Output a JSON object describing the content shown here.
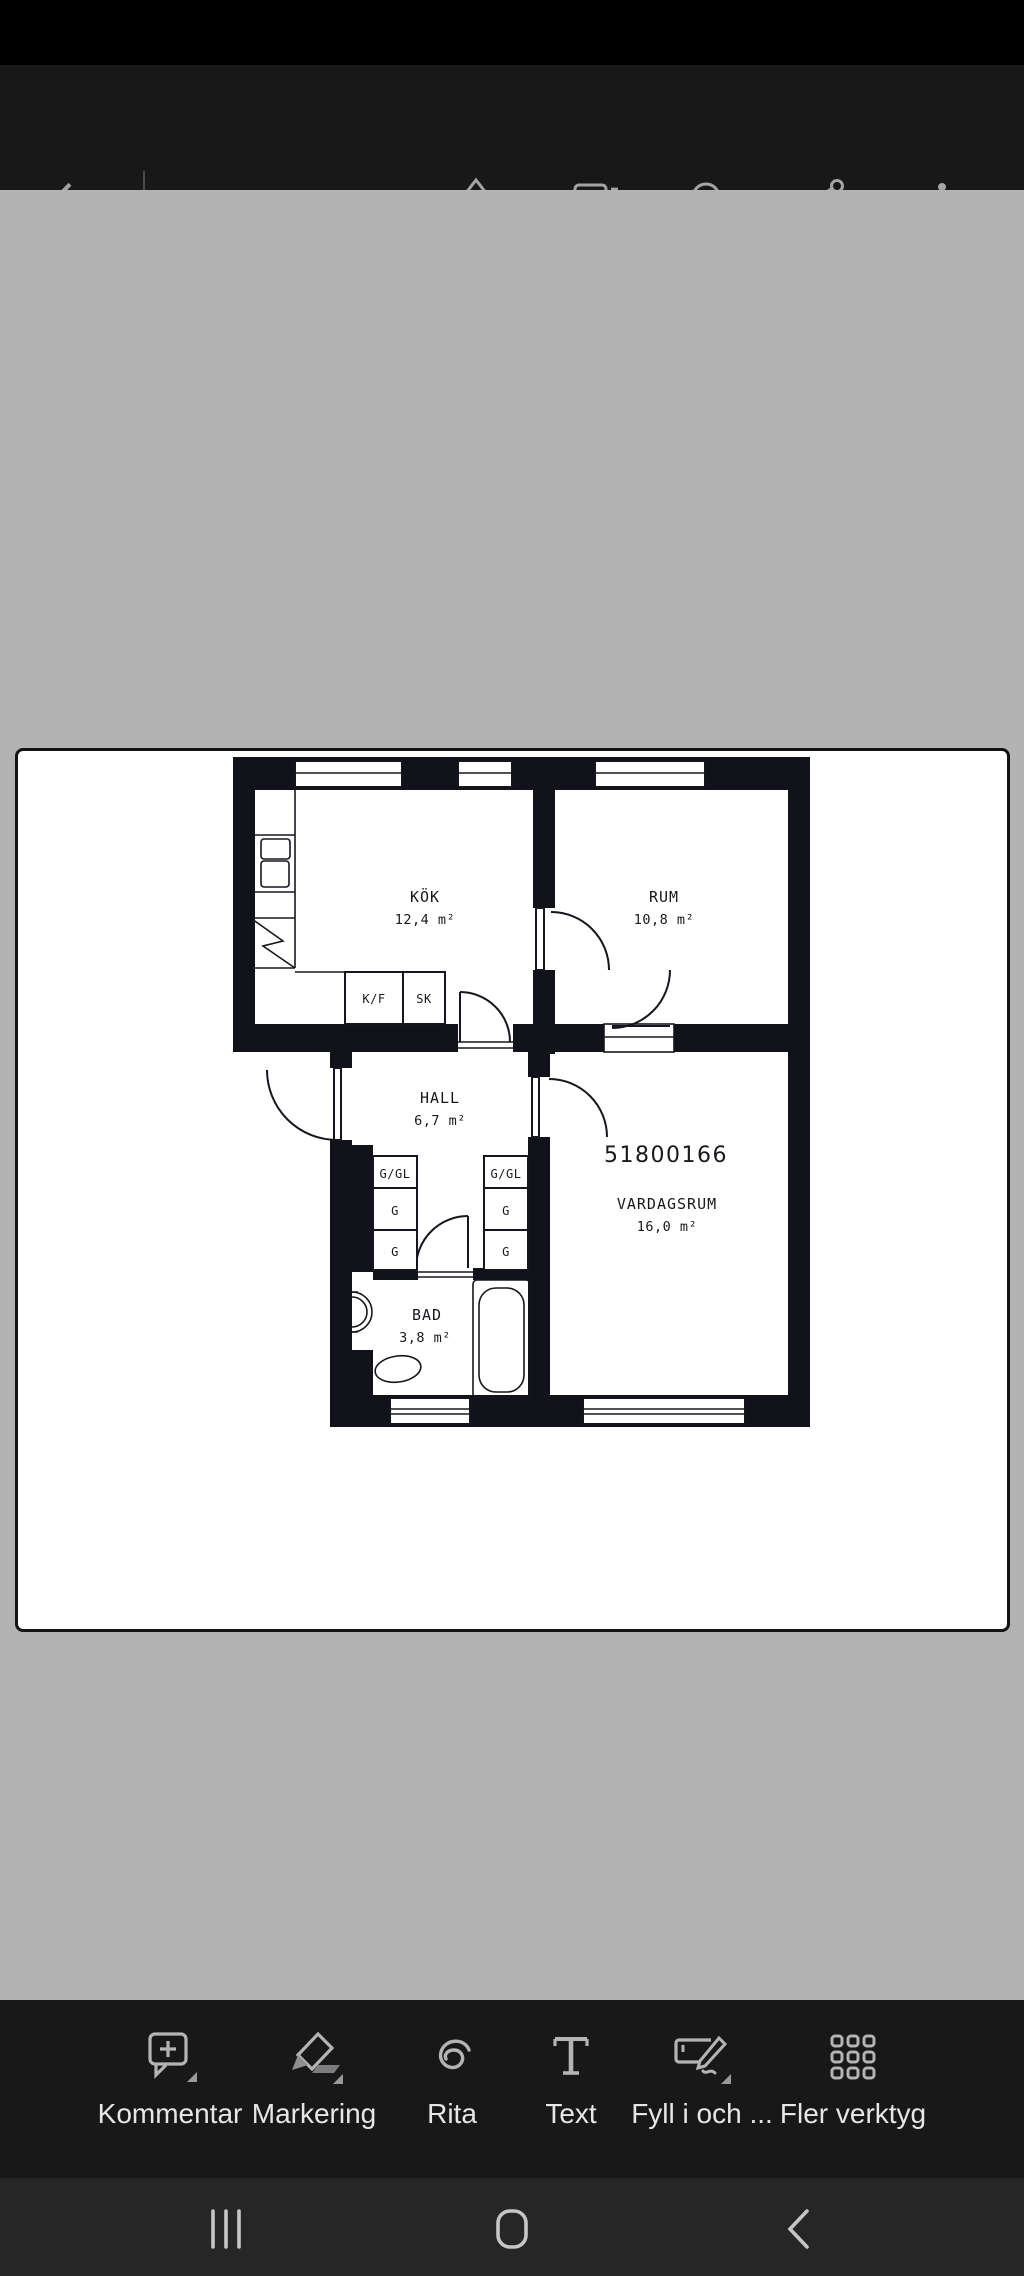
{
  "colors": {
    "status_bar": "#000000",
    "toolbar_dark": "#181818",
    "viewer_gray": "#b3b3b3",
    "nav_bar": "#262626",
    "top_icon_gray": "#a4a4a6",
    "bottom_icon_gray": "#b4b4b6",
    "label_light": "#e7e7e9",
    "plan_ink": "#12121a"
  },
  "top_toolbar": {
    "icons": [
      "back-arrow",
      "liquid-mode",
      "comment",
      "search",
      "share",
      "overflow-menu"
    ]
  },
  "floor_plan": {
    "plan_number": "51800166",
    "rooms": {
      "kitchen": {
        "name": "KÖK",
        "area": "12,4 m²"
      },
      "room": {
        "name": "RUM",
        "area": "10,8 m²"
      },
      "hall": {
        "name": "HALL",
        "area": "6,7 m²"
      },
      "living_room": {
        "name": "VARDAGSRUM",
        "area": "16,0 m²"
      },
      "bathroom": {
        "name": "BAD",
        "area": "3,8 m²"
      }
    },
    "cabinets": {
      "kf": "K/F",
      "sk": "SK",
      "left_top": "G/GL",
      "left_mid": "G",
      "left_bot": "G",
      "right_top": "G/GL",
      "right_mid": "G",
      "right_bot": "G"
    }
  },
  "bottom_toolbar": {
    "items": [
      {
        "label": "Kommentar",
        "icon": "comment-add",
        "has_submenu": true
      },
      {
        "label": "Markering",
        "icon": "highlighter",
        "has_submenu": true
      },
      {
        "label": "Rita",
        "icon": "draw-scribble",
        "has_submenu": false
      },
      {
        "label": "Text",
        "icon": "text-tool",
        "has_submenu": false
      },
      {
        "label": "Fyll i och ...",
        "icon": "fill-and-sign",
        "has_submenu": true
      },
      {
        "label": "Fler verktyg",
        "icon": "more-tools-grid",
        "has_submenu": false
      }
    ]
  },
  "nav_bar": {
    "buttons": [
      "recents",
      "home",
      "back"
    ]
  }
}
